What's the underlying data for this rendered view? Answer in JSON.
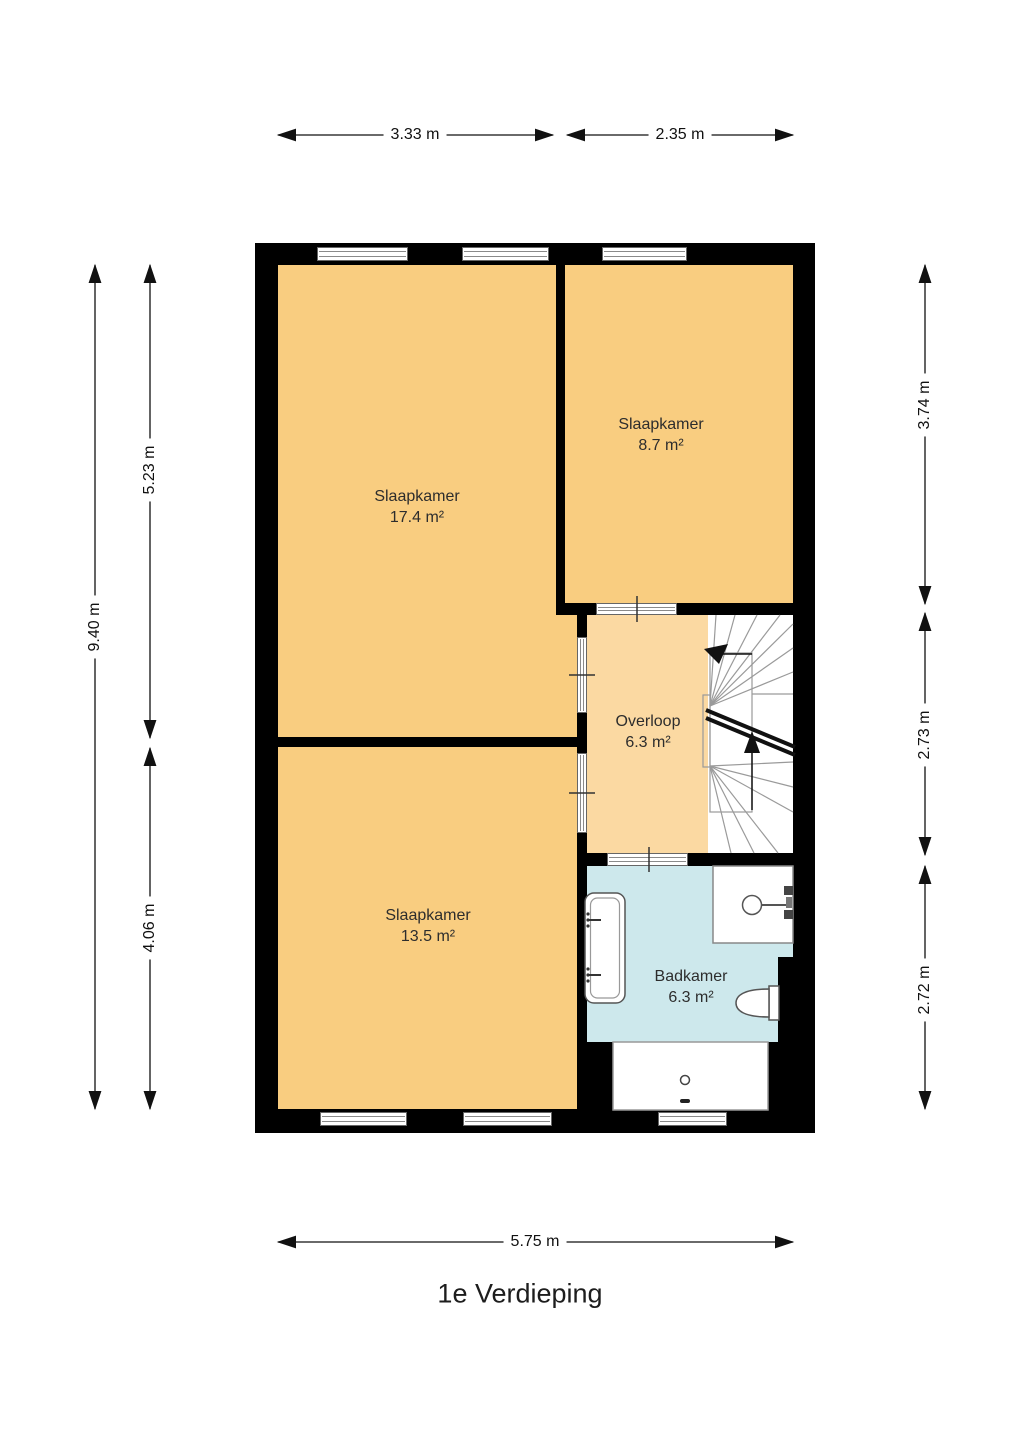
{
  "title": "1e Verdieping",
  "colors": {
    "wall": "#000000",
    "bedroom_fill": "#F9CD80",
    "landing_fill": "#FBD9A2",
    "bathroom_fill": "#CDE8EC",
    "stairs_fill": "#FFFFFF"
  },
  "rooms": {
    "bedroom_large": {
      "name": "Slaapkamer",
      "area": "17.4 m²"
    },
    "bedroom_small": {
      "name": "Slaapkamer",
      "area": "8.7 m²"
    },
    "landing": {
      "name": "Overloop",
      "area": "6.3 m²"
    },
    "bedroom_bottom": {
      "name": "Slaapkamer",
      "area": "13.5 m²"
    },
    "bathroom": {
      "name": "Badkamer",
      "area": "6.3 m²"
    }
  },
  "dimensions": {
    "top": [
      "3.33 m",
      "2.35 m"
    ],
    "left_outer": "9.40 m",
    "left_inner": [
      "5.23 m",
      "4.06 m"
    ],
    "right": [
      "3.74 m",
      "2.73 m",
      "2.72 m"
    ],
    "bottom": "5.75 m"
  }
}
